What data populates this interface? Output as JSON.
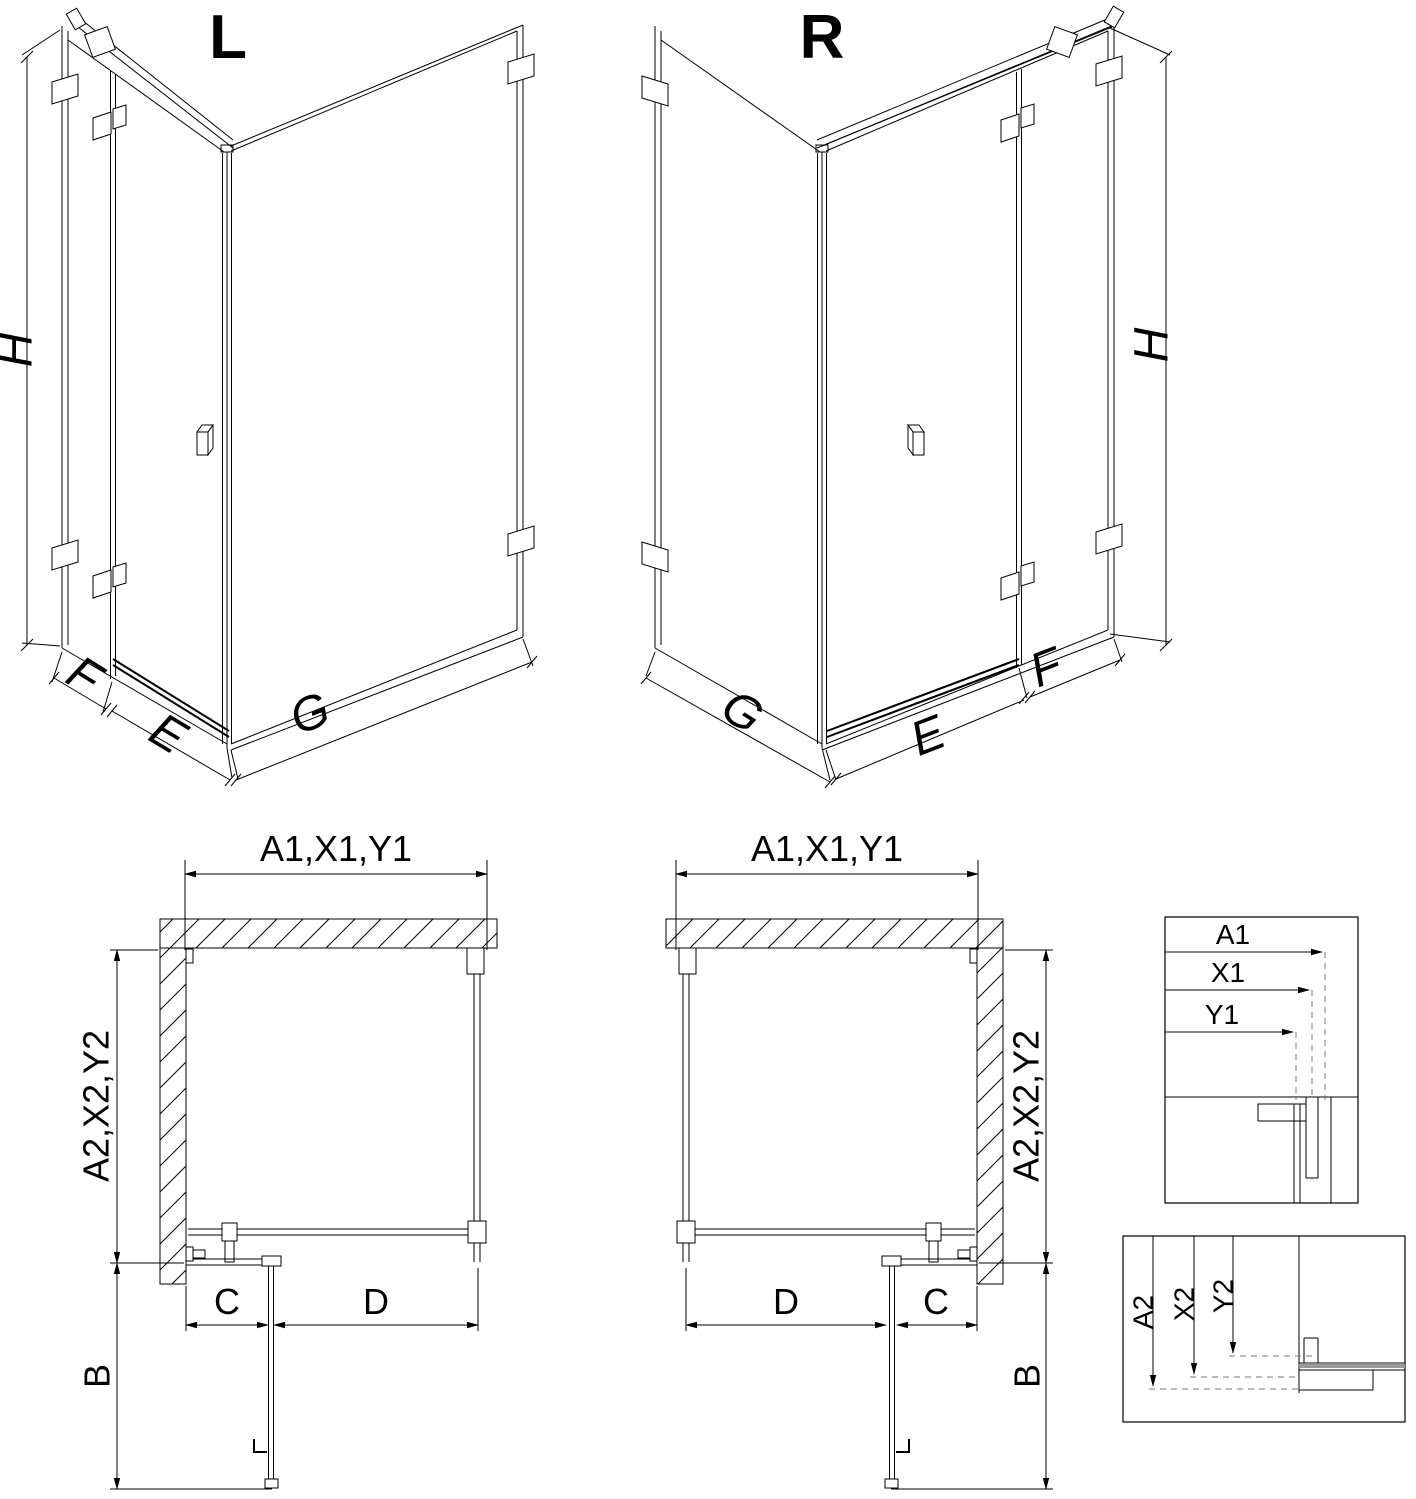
{
  "drawing": {
    "background": "#ffffff",
    "line_color": "#000000",
    "dash_color": "#777777",
    "iso_left": {
      "variant": "L",
      "height_label": "H",
      "fixed_panel_label": "F",
      "door_label": "E",
      "return_panel_label": "G"
    },
    "iso_right": {
      "variant": "R",
      "height_label": "H",
      "fixed_panel_label": "F",
      "door_label": "E",
      "return_panel_label": "G"
    },
    "plan_left": {
      "top_label": "A1,X1,Y1",
      "side_label": "A2,X2,Y2",
      "door_swing_label": "B",
      "fixed_width_label": "C",
      "panel_width_label": "D"
    },
    "plan_right": {
      "top_label": "A1,X1,Y1",
      "side_label": "A2,X2,Y2",
      "door_swing_label": "B",
      "fixed_width_label": "C",
      "panel_width_label": "D"
    },
    "detail_width": {
      "labels": [
        "A1",
        "X1",
        "Y1"
      ]
    },
    "detail_depth": {
      "labels": [
        "A2",
        "X2",
        "Y2"
      ]
    }
  }
}
